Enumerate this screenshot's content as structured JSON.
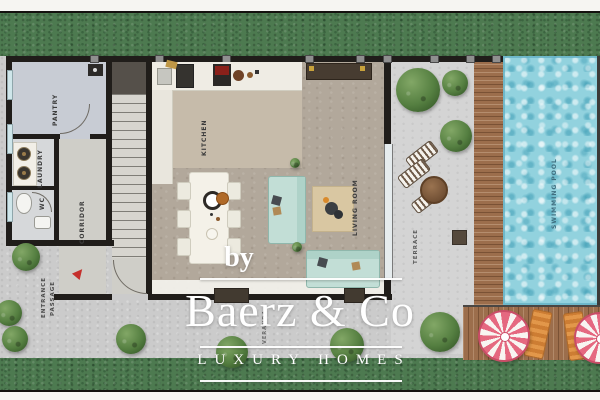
{
  "plan": {
    "labels": {
      "pantry": "PANTRY",
      "laundry": "LAUNDRY",
      "wc": "WC",
      "corridor": "CORRIDOR",
      "kitchen": "KITCHEN",
      "living_room": "LIVING ROOM",
      "terrace": "TERRACE",
      "veranda": "VERANDA",
      "swimming_pool": "SWIMMING POOL",
      "entrance_line1": "ENTRANCE",
      "entrance_line2": "PASSAGE"
    },
    "watermark": {
      "prefix": "by",
      "brand": "Baerz & Co",
      "tagline": "LUXURY HOMES"
    },
    "colors": {
      "grass": "#4d7a50",
      "pavement": "#cbcbcb",
      "pool_water": "#92d2de",
      "deck_wood": "#9c6e4c",
      "wall": "#201d1a",
      "living_floor": "#b2a89b",
      "kitchen_floor": "#c6bbaa",
      "sofa_teal": "#c2ded6",
      "umbrella_pink": "#e56880",
      "lounger_orange": "#e2974a",
      "entrance_arrow_red": "#c5302c",
      "watermark_white": "#ffffff"
    }
  }
}
